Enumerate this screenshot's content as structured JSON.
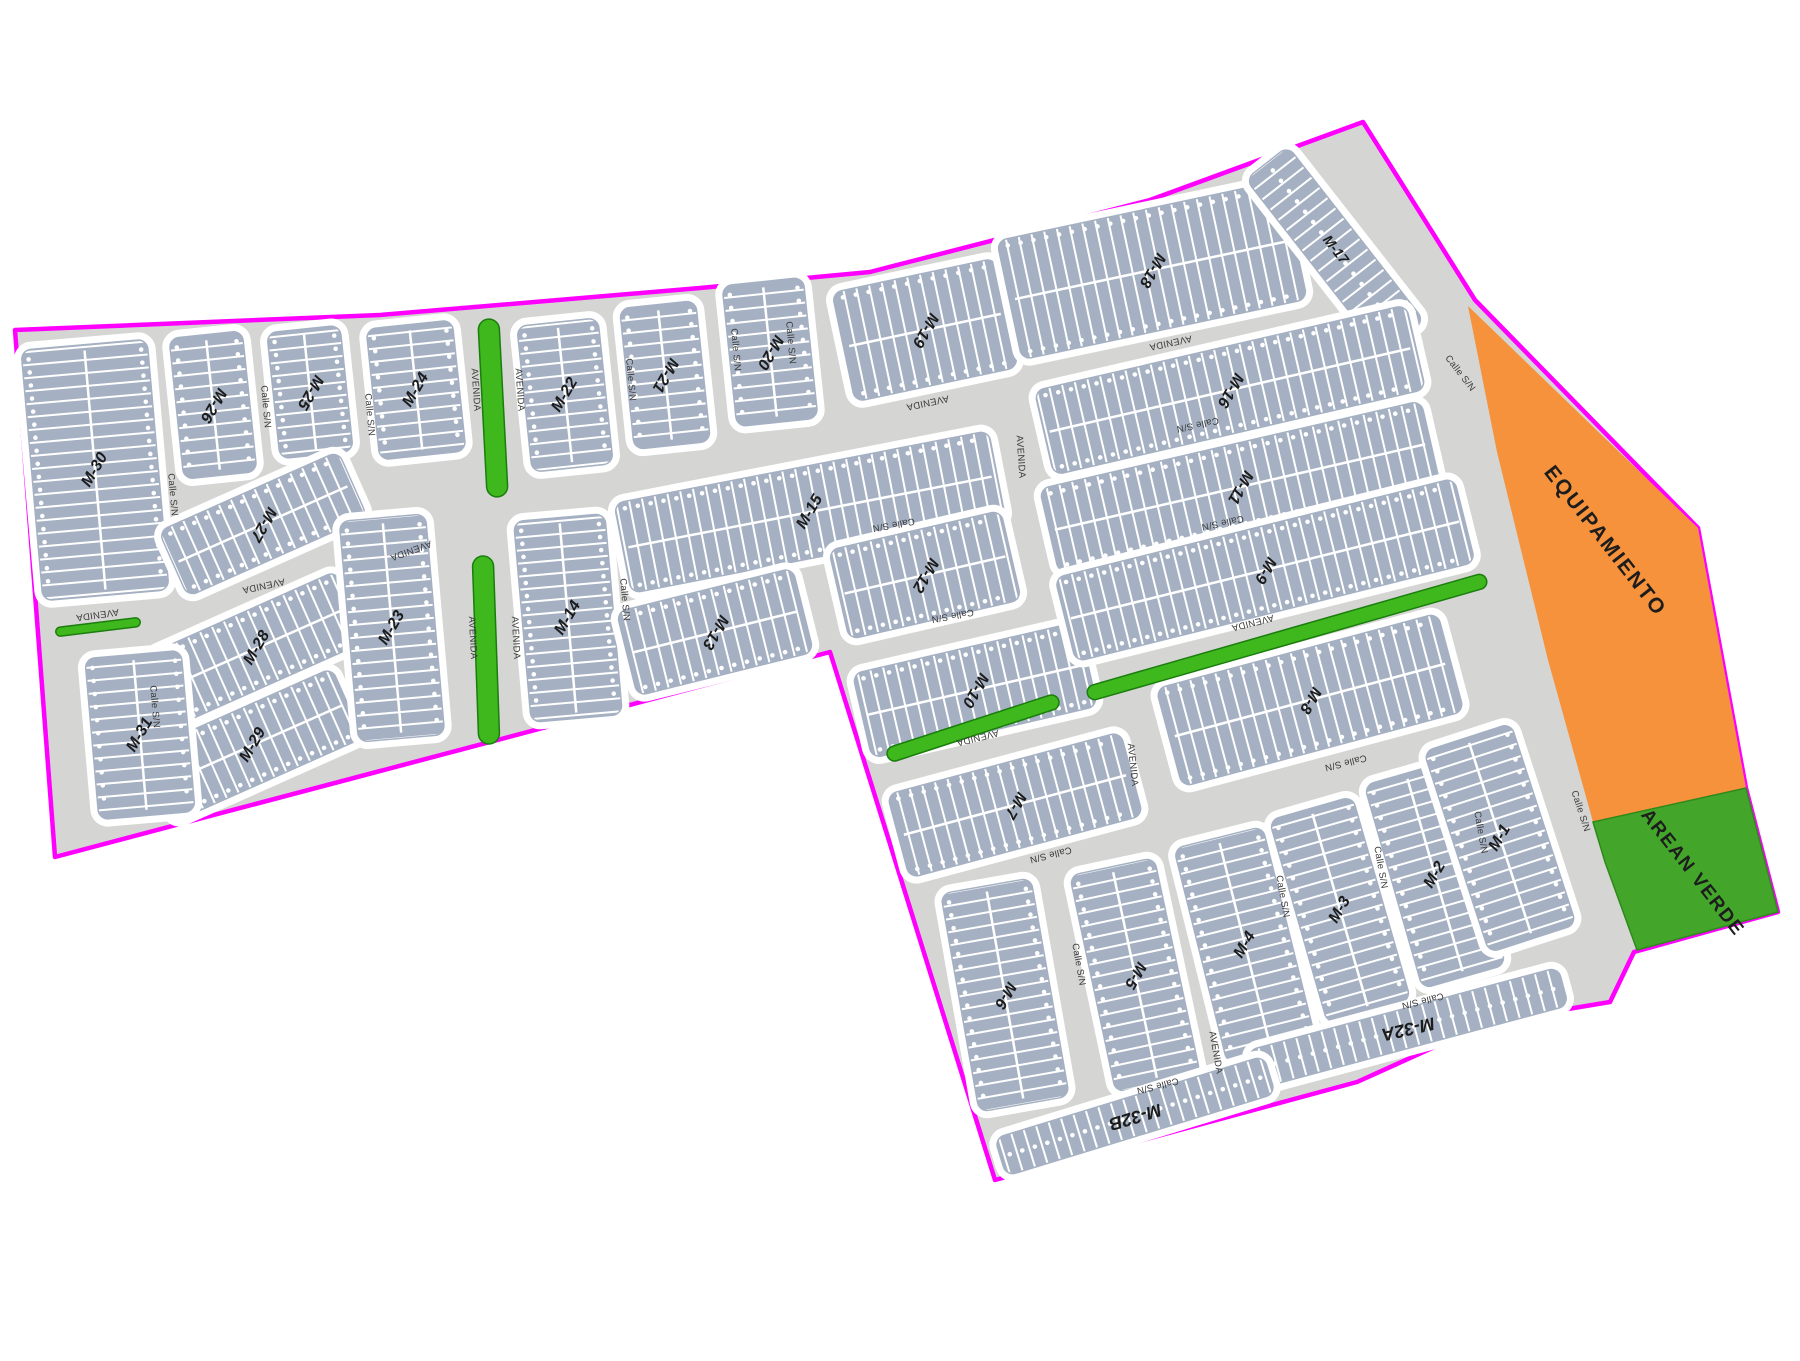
{
  "map": {
    "background": "#ffffff",
    "street_color": "#d5d5d3",
    "block_color": "#a5b1c2",
    "lot_line_color": "#ffffff",
    "boundary_color": "#ff00ff",
    "median_color": "#3eb81c",
    "median_stroke": "#1b7d0e",
    "equipamiento_color": "#f6923b",
    "area_verde_color": "#43a52a",
    "block_label_color": "#1b1b1b",
    "street_label_color": "#3a3a3a"
  },
  "boundary_points": "15,330 380,315 700,288 870,272 1150,200 1363,122 1475,300 1698,528 1746,788 1778,912 1634,952 1610,1002 1490,1022 1357,1082 995,1180 830,652 55,857",
  "regions": {
    "equipamiento": {
      "label": "EQUIPAMIENTO",
      "points": "1468,306 1698,528 1746,788 1593,822 1548,660 1497,452",
      "label_transform": "translate(1600,545) rotate(52)"
    },
    "area_verde": {
      "label": "AREAN VERDE",
      "points": "1593,822 1746,788 1778,912 1637,950 1605,862",
      "label_transform": "translate(1688,876) rotate(52)"
    }
  },
  "medians": [
    {
      "x": 98,
      "y": 627,
      "len": 85,
      "w": 9,
      "rot": -7
    },
    {
      "x": 493,
      "y": 408,
      "len": 178,
      "w": 21,
      "rot": 87
    },
    {
      "x": 486,
      "y": 650,
      "len": 188,
      "w": 21,
      "rot": 88
    },
    {
      "x": 973,
      "y": 728,
      "len": 180,
      "w": 15,
      "rot": -18
    },
    {
      "x": 1287,
      "y": 637,
      "len": 415,
      "w": 15,
      "rot": -16
    }
  ],
  "blocks": [
    {
      "label": "M-30",
      "x": 95,
      "y": 470,
      "l": 260,
      "w": 135,
      "r": 85,
      "lr": -60,
      "rows": 2
    },
    {
      "label": "M-26",
      "x": 213,
      "y": 405,
      "l": 150,
      "w": 82,
      "r": 84,
      "lr": 120,
      "rows": 2
    },
    {
      "label": "M-25",
      "x": 310,
      "y": 392,
      "l": 135,
      "w": 82,
      "r": 84,
      "lr": 120,
      "rows": 2
    },
    {
      "label": "M-24",
      "x": 416,
      "y": 390,
      "l": 140,
      "w": 95,
      "r": 84,
      "lr": -60,
      "rows": 2
    },
    {
      "label": "M-27",
      "x": 263,
      "y": 524,
      "l": 205,
      "w": 80,
      "r": -24,
      "lr": 120,
      "rows": 2
    },
    {
      "label": "M-28",
      "x": 257,
      "y": 648,
      "l": 215,
      "w": 85,
      "r": -24,
      "lr": -60,
      "rows": 2
    },
    {
      "label": "M-29",
      "x": 253,
      "y": 745,
      "l": 215,
      "w": 85,
      "r": -24,
      "lr": -60,
      "rows": 2
    },
    {
      "label": "M-31",
      "x": 140,
      "y": 735,
      "l": 170,
      "w": 105,
      "r": 85,
      "lr": -60,
      "rows": 2
    },
    {
      "label": "M-23",
      "x": 392,
      "y": 628,
      "l": 230,
      "w": 95,
      "r": 85,
      "lr": -60,
      "rows": 2
    },
    {
      "label": "M-22",
      "x": 565,
      "y": 395,
      "l": 155,
      "w": 90,
      "r": 84,
      "lr": -60,
      "rows": 2
    },
    {
      "label": "M-21",
      "x": 665,
      "y": 375,
      "l": 150,
      "w": 85,
      "r": 84,
      "lr": 120,
      "rows": 2
    },
    {
      "label": "M-20",
      "x": 770,
      "y": 352,
      "l": 150,
      "w": 90,
      "r": 84,
      "lr": 120,
      "rows": 2
    },
    {
      "label": "M-19",
      "x": 925,
      "y": 330,
      "l": 175,
      "w": 120,
      "r": -12,
      "lr": 120,
      "rows": 2
    },
    {
      "label": "M-18",
      "x": 1152,
      "y": 270,
      "l": 300,
      "w": 130,
      "r": -12,
      "lr": 120,
      "rows": 2
    },
    {
      "label": "M-17",
      "x": 1335,
      "y": 250,
      "l": 230,
      "w": 62,
      "r": 52,
      "lr": 52,
      "rows": 1,
      "fs": 14
    },
    {
      "label": "M-16",
      "x": 1230,
      "y": 390,
      "l": 390,
      "w": 95,
      "r": -13,
      "lr": 120,
      "rows": 2
    },
    {
      "label": "M-15",
      "x": 810,
      "y": 512,
      "l": 390,
      "w": 100,
      "r": -11,
      "lr": -60,
      "rows": 2
    },
    {
      "label": "M-14",
      "x": 568,
      "y": 618,
      "l": 210,
      "w": 100,
      "r": 85,
      "lr": -60,
      "rows": 2
    },
    {
      "label": "M-13",
      "x": 715,
      "y": 632,
      "l": 190,
      "w": 95,
      "r": -14,
      "lr": 120,
      "rows": 2
    },
    {
      "label": "M-12",
      "x": 925,
      "y": 575,
      "l": 185,
      "w": 100,
      "r": -13,
      "lr": 120,
      "rows": 2
    },
    {
      "label": "M-11",
      "x": 1240,
      "y": 487,
      "l": 400,
      "w": 95,
      "r": -13,
      "lr": 120,
      "rows": 2
    },
    {
      "label": "M-10",
      "x": 975,
      "y": 690,
      "l": 240,
      "w": 95,
      "r": -13,
      "lr": 120,
      "rows": 2
    },
    {
      "label": "M-9",
      "x": 1265,
      "y": 570,
      "l": 420,
      "w": 95,
      "r": -14,
      "lr": 120,
      "rows": 2
    },
    {
      "label": "M-8",
      "x": 1310,
      "y": 700,
      "l": 300,
      "w": 110,
      "r": -15,
      "lr": 120,
      "rows": 2
    },
    {
      "label": "M-7",
      "x": 1015,
      "y": 805,
      "l": 250,
      "w": 95,
      "r": -15,
      "lr": 120,
      "rows": 2
    },
    {
      "label": "M-6",
      "x": 1005,
      "y": 995,
      "l": 230,
      "w": 100,
      "r": 80,
      "lr": 120,
      "rows": 2
    },
    {
      "label": "M-5",
      "x": 1135,
      "y": 975,
      "l": 230,
      "w": 95,
      "r": 78,
      "lr": 120,
      "rows": 2
    },
    {
      "label": "M-4",
      "x": 1245,
      "y": 945,
      "l": 230,
      "w": 100,
      "r": 76,
      "lr": -60,
      "rows": 2
    },
    {
      "label": "M-3",
      "x": 1340,
      "y": 910,
      "l": 220,
      "w": 95,
      "r": 74,
      "lr": -60,
      "rows": 2
    },
    {
      "label": "M-2",
      "x": 1435,
      "y": 875,
      "l": 220,
      "w": 95,
      "r": 74,
      "lr": -60,
      "rows": 2
    },
    {
      "label": "M-1",
      "x": 1500,
      "y": 838,
      "l": 220,
      "w": 100,
      "r": 72,
      "lr": -60,
      "rows": 2
    },
    {
      "label": "M-32A",
      "x": 1408,
      "y": 1028,
      "l": 330,
      "w": 48,
      "r": -15,
      "lr": 167,
      "rows": 1,
      "fs": 18
    },
    {
      "label": "M-32B",
      "x": 1135,
      "y": 1116,
      "l": 290,
      "w": 48,
      "r": -17,
      "lr": 163,
      "rows": 1,
      "fs": 18
    }
  ],
  "street_labels": [
    {
      "text": "Calle S/N",
      "x": 170,
      "y": 495,
      "rot": 85
    },
    {
      "text": "Calle S/N",
      "x": 263,
      "y": 407,
      "rot": 85
    },
    {
      "text": "Calle S/N",
      "x": 367,
      "y": 415,
      "rot": 85
    },
    {
      "text": "Calle S/N",
      "x": 152,
      "y": 707,
      "rot": 85
    },
    {
      "text": "AVENIDA",
      "x": 97,
      "y": 612,
      "rot": 172
    },
    {
      "text": "AVENIDA",
      "x": 263,
      "y": 583,
      "rot": 168
    },
    {
      "text": "AVENIDA",
      "x": 473,
      "y": 390,
      "rot": 86
    },
    {
      "text": "AVENIDA",
      "x": 517,
      "y": 390,
      "rot": 86
    },
    {
      "text": "AVENIDA",
      "x": 410,
      "y": 548,
      "rot": 160
    },
    {
      "text": "AVENIDA",
      "x": 470,
      "y": 638,
      "rot": 87
    },
    {
      "text": "AVENIDA",
      "x": 513,
      "y": 638,
      "rot": 87
    },
    {
      "text": "Calle S/N",
      "x": 628,
      "y": 380,
      "rot": 85
    },
    {
      "text": "Calle S/N",
      "x": 733,
      "y": 350,
      "rot": 85
    },
    {
      "text": "Calle S/N",
      "x": 788,
      "y": 343,
      "rot": 85
    },
    {
      "text": "AVENIDA",
      "x": 927,
      "y": 400,
      "rot": 168
    },
    {
      "text": "AVENIDA",
      "x": 1170,
      "y": 340,
      "rot": 168
    },
    {
      "text": "Calle S/N",
      "x": 893,
      "y": 522,
      "rot": 170
    },
    {
      "text": "Calle S/N",
      "x": 952,
      "y": 613,
      "rot": 170
    },
    {
      "text": "Calle S/N",
      "x": 622,
      "y": 600,
      "rot": 85
    },
    {
      "text": "AVENIDA",
      "x": 977,
      "y": 735,
      "rot": 166
    },
    {
      "text": "AVENIDA",
      "x": 1018,
      "y": 457,
      "rot": 86
    },
    {
      "text": "AVENIDA",
      "x": 1130,
      "y": 765,
      "rot": 84
    },
    {
      "text": "AVENIDA",
      "x": 1213,
      "y": 1053,
      "rot": 80
    },
    {
      "text": "Calle S/N",
      "x": 1197,
      "y": 422,
      "rot": 168
    },
    {
      "text": "Calle S/N",
      "x": 1222,
      "y": 520,
      "rot": 168
    },
    {
      "text": "AVENIDA",
      "x": 1252,
      "y": 620,
      "rot": 166
    },
    {
      "text": "Calle S/N",
      "x": 1345,
      "y": 760,
      "rot": 166
    },
    {
      "text": "Calle S/N",
      "x": 1458,
      "y": 375,
      "rot": 52
    },
    {
      "text": "Calle S/N",
      "x": 1578,
      "y": 812,
      "rot": 72
    },
    {
      "text": "Calle S/N",
      "x": 1076,
      "y": 965,
      "rot": 80
    },
    {
      "text": "Calle S/N",
      "x": 1050,
      "y": 852,
      "rot": 166
    },
    {
      "text": "Calle S/N",
      "x": 1157,
      "y": 1083,
      "rot": 166
    },
    {
      "text": "Calle S/N",
      "x": 1280,
      "y": 897,
      "rot": 80
    },
    {
      "text": "Calle S/N",
      "x": 1378,
      "y": 868,
      "rot": 80
    },
    {
      "text": "Calle S/N",
      "x": 1478,
      "y": 833,
      "rot": 80
    },
    {
      "text": "Calle S/N",
      "x": 1422,
      "y": 998,
      "rot": 166
    }
  ]
}
